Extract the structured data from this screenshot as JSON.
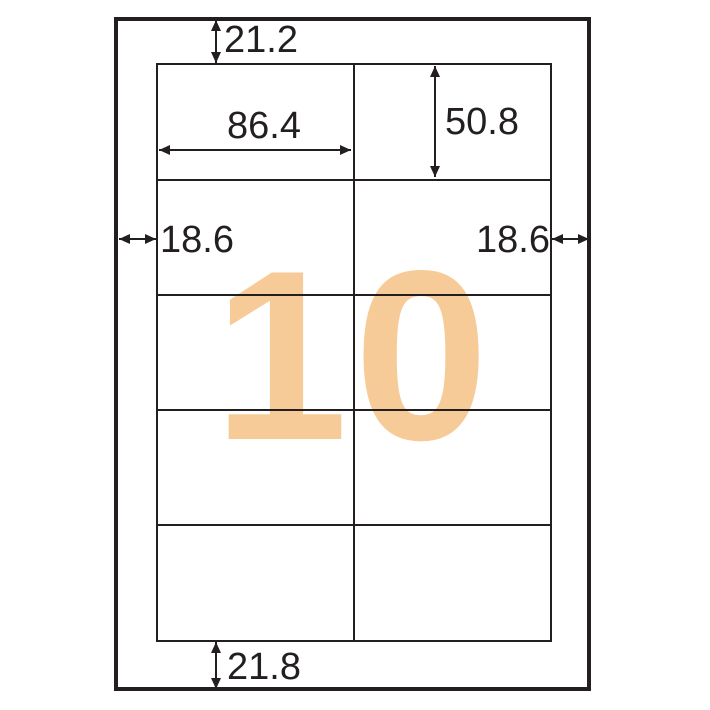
{
  "diagram": {
    "type": "label-sheet-dimension-diagram",
    "label_count": "10",
    "grid": {
      "columns": 2,
      "rows": 5
    },
    "dimensions": {
      "top_margin": "21.2",
      "label_width": "86.4",
      "label_height": "50.8",
      "left_margin": "18.6",
      "right_margin": "18.6",
      "bottom_margin": "21.8"
    },
    "colors": {
      "line": "#231f20",
      "accent_numeral": "#f6cb98",
      "background": "#ffffff"
    }
  }
}
